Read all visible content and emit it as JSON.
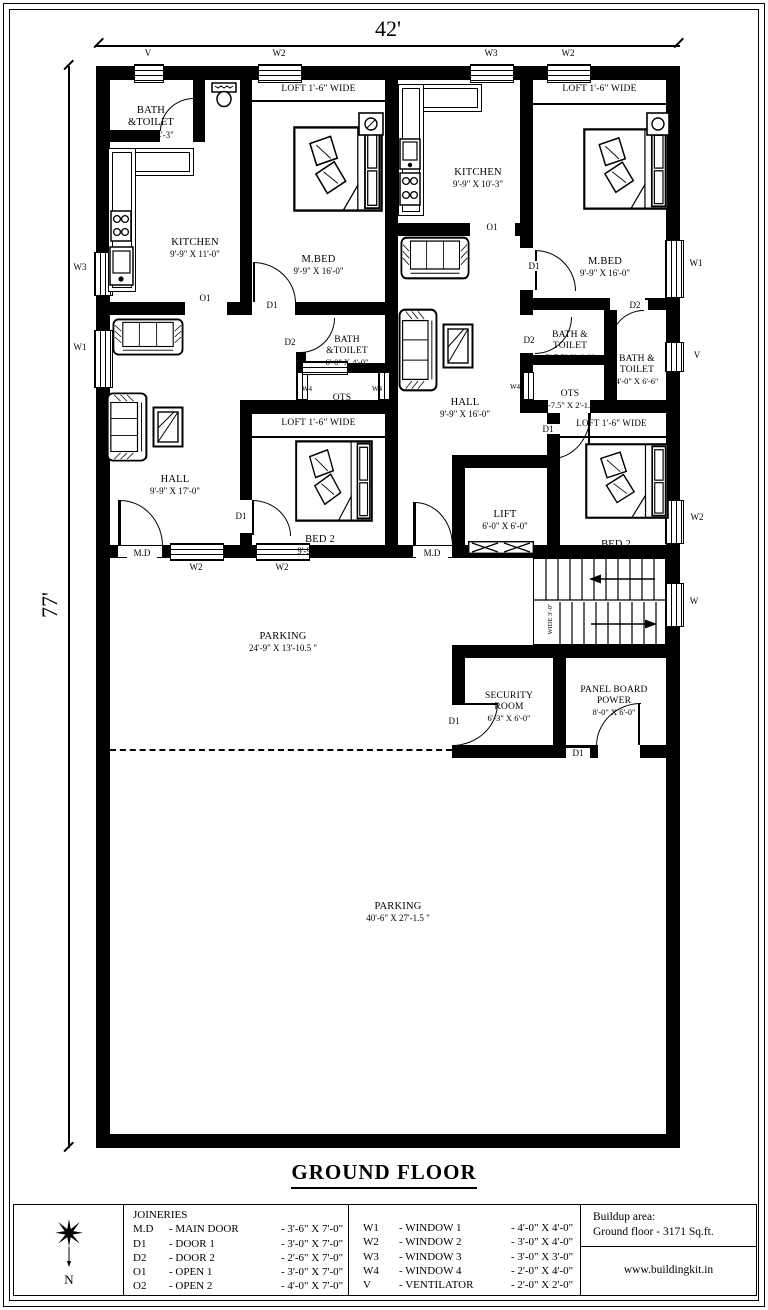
{
  "page": {
    "title": "GROUND FLOOR",
    "width_dim": "42'",
    "height_dim": "77'"
  },
  "labels": {
    "loft": "LOFT 1'-6\" WIDE"
  },
  "codes": {
    "v": "V",
    "w": "W",
    "w1": "W1",
    "w2": "W2",
    "w3": "W3",
    "w4": "W4",
    "d1": "D1",
    "d2": "D2",
    "o1": "O1",
    "md": "M.D"
  },
  "rooms": {
    "bath_tl": {
      "name": "BATH\n&TOILET",
      "dims": "6'-6\" X 4'-3\""
    },
    "kitchen_l": {
      "name": "KITCHEN",
      "dims": "9'-9\" X 11'-0\""
    },
    "mbed_l": {
      "name": "M.BED",
      "dims": "9'-9\" X 16'-0\""
    },
    "kitchen_r": {
      "name": "KITCHEN",
      "dims": "9'-9\" X 10'-3\""
    },
    "mbed_r": {
      "name": "M.BED",
      "dims": "9'-9\" X 16'-0\""
    },
    "bath_ml": {
      "name": "BATH\n&TOILET",
      "dims": "6'-0\" X 4'-0\""
    },
    "ots_l": {
      "name": "OTS",
      "dims": "5'-7.5\"X 2'-1.5\""
    },
    "hall_l": {
      "name": "HALL",
      "dims": "9'-9\" X 17'-0\""
    },
    "hall_r": {
      "name": "HALL",
      "dims": "9'-9\" X 16'-0\""
    },
    "bath_r1": {
      "name": "BATH &\nTOILET",
      "dims": "5'-7.5\" X 4'-0\""
    },
    "bath_r2": {
      "name": "BATH &\nTOILET",
      "dims": "4'-0\" X 6'-6\""
    },
    "ots_r": {
      "name": "OTS",
      "dims": "4'-7.5\" X 2'-1.5\""
    },
    "bed2_l": {
      "name": "BED 2",
      "dims": "9'-9\" X 9'-9\""
    },
    "bed2_r": {
      "name": "BED 2",
      "dims": "8'-3\" X 10'-0\""
    },
    "lift": {
      "name": "LIFT",
      "dims": "6'-0\" X 6'-0\""
    },
    "parking1": {
      "name": "PARKING",
      "dims": "24'-9\" X 13'-10.5 \""
    },
    "security": {
      "name": "SECURITY\nROOM",
      "dims": "6'-3\" X 6'-0\""
    },
    "panel": {
      "name": "PANEL BOARD\nPOWER",
      "dims": "8'-0\" X 6'-0\""
    },
    "parking2": {
      "name": "PARKING",
      "dims": "40'-6\" X 27'-1.5 \""
    }
  },
  "stairs": {
    "note": "WIDE 3'-0\""
  },
  "legend": {
    "joineries_title": "JOINERIES",
    "joineries": [
      {
        "code": "M.D",
        "name": "- MAIN DOOR",
        "size": "- 3'-6\" X 7'-0\""
      },
      {
        "code": "D1",
        "name": "- DOOR 1",
        "size": "- 3'-0\" X 7'-0\""
      },
      {
        "code": "D2",
        "name": "- DOOR 2",
        "size": "- 2'-6\" X 7'-0\""
      },
      {
        "code": "O1",
        "name": "- OPEN 1",
        "size": "- 3'-0\" X 7'-0\""
      },
      {
        "code": "O2",
        "name": "- OPEN 2",
        "size": "- 4'-0\" X 7'-0\""
      }
    ],
    "windows": [
      {
        "code": "W1",
        "name": "- WINDOW 1",
        "size": "- 4'-0\" X 4'-0\""
      },
      {
        "code": "W2",
        "name": "- WINDOW 2",
        "size": "- 3'-0\" X 4'-0\""
      },
      {
        "code": "W3",
        "name": "- WINDOW 3",
        "size": "- 3'-0\" X 3'-0\""
      },
      {
        "code": "W4",
        "name": "- WINDOW 4",
        "size": "- 2'-0\" X 4'-0\""
      },
      {
        "code": "V",
        "name": "- VENTILATOR",
        "size": "- 2'-0\" X 2'-0\""
      }
    ]
  },
  "footer": {
    "buildup_label": "Buildup area:",
    "buildup_value": "Ground floor - 3171 Sq.ft.",
    "website": "www.buildingkit.in"
  },
  "compass": {
    "north": "N"
  }
}
